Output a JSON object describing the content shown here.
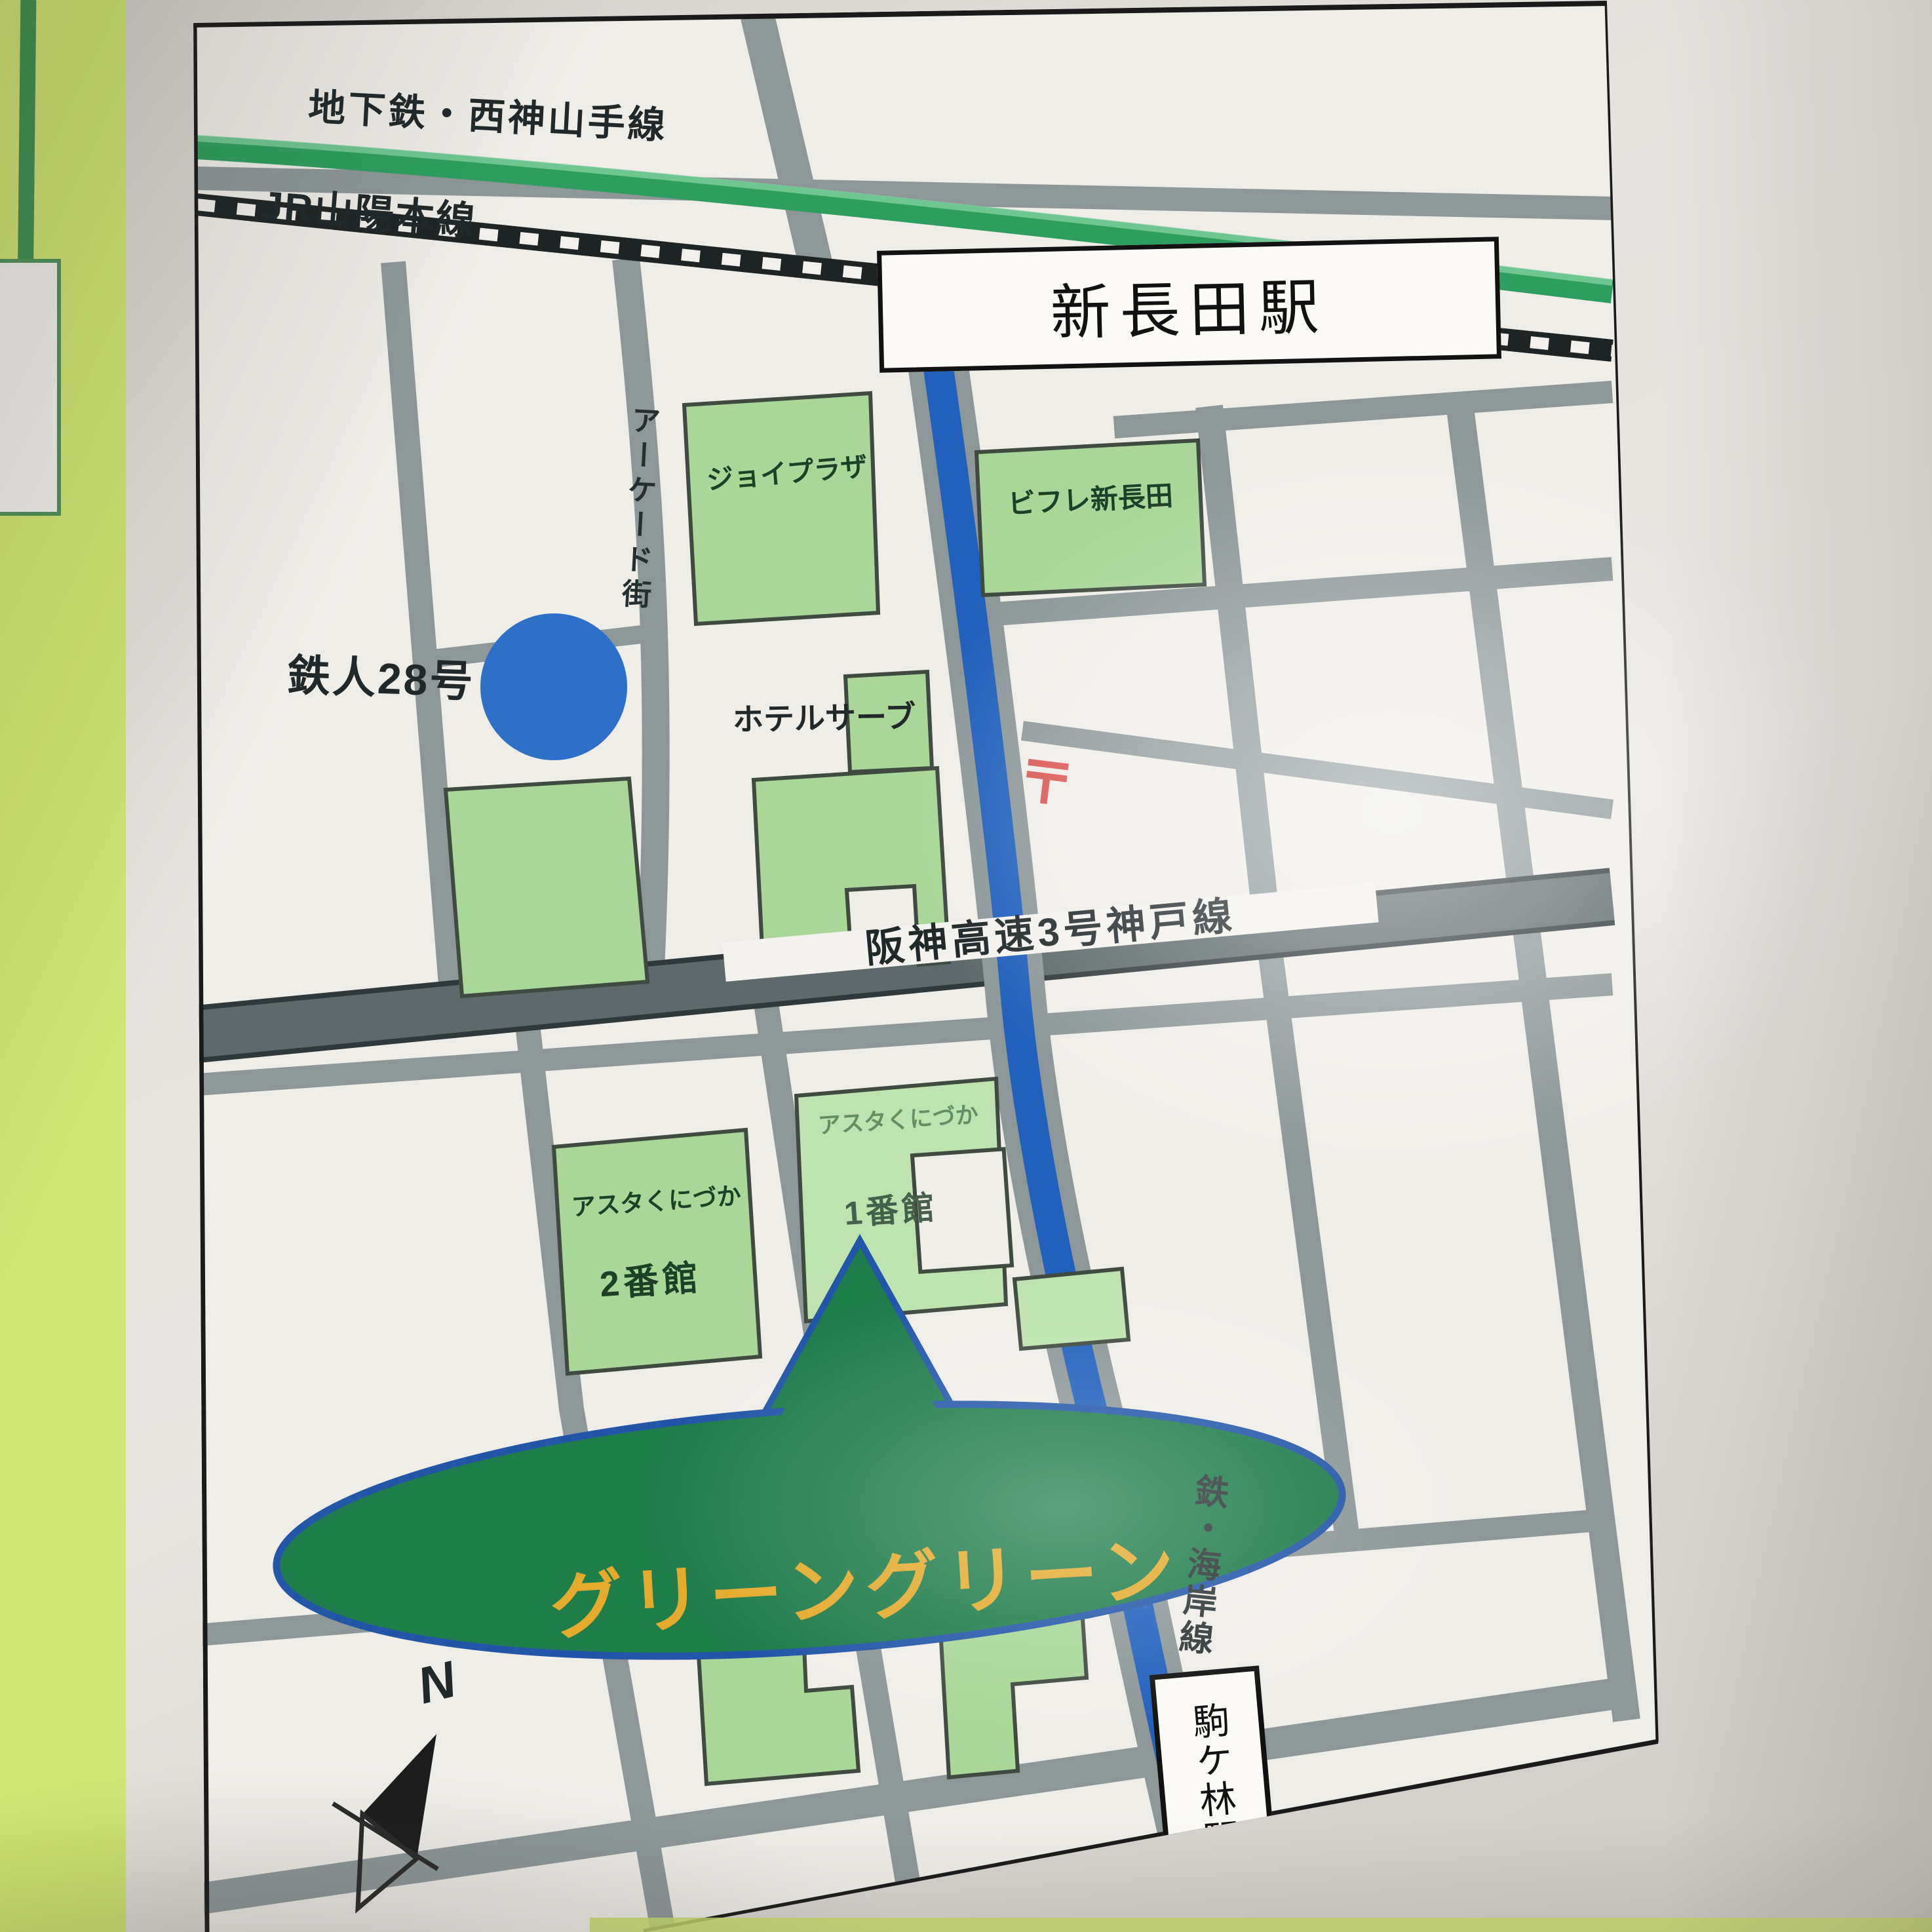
{
  "map_title": "グリーングリーン 周辺アクセスマップ",
  "lines": {
    "seishin_yamate": "地下鉄・西神山手線",
    "jr_sanyo": "JR山陽本線",
    "hanshin_expressway": "阪神高速3号神戸線",
    "kaigan": "鉄・海岸線"
  },
  "stations": {
    "shin_nagata": "新長田駅",
    "komagabayashi": "駒ケ林駅"
  },
  "buildings": {
    "joy_plaza": "ジョイプラザ",
    "bifure_shinnagata": "ビフレ新長田",
    "hotel_serve": "ホテルサーブ",
    "asta_kunizuka_2": {
      "name": "アスタくにづか",
      "num": "2番館"
    },
    "asta_kunizuka_1": {
      "name": "アスタくにづか",
      "num": "1番館"
    }
  },
  "landmarks": {
    "green_green": "グリーングリーン",
    "tetsujin28": "鉄人28号",
    "arcade_street": "アーケード街"
  },
  "symbols": {
    "post_office_mark": "〒",
    "compass_north": "N"
  },
  "colors": {
    "subway_line_green": "#2e9e60",
    "road_gray": "#8d9798",
    "expressway_gray": "#5d696b",
    "rail_black": "#1e2424",
    "subway_blue_road": "#2160bd",
    "building_green": "#a8d797",
    "building_green_light": "#bfe3ae",
    "green_green_fill": "#1f7c4b",
    "green_green_outline": "#2356a8",
    "green_green_text_gold": "#e3aa2b",
    "tetsujin_blue": "#2e6fca",
    "post_mark_red": "#d9534f",
    "page_band_chartreuse": "#cfe472"
  }
}
